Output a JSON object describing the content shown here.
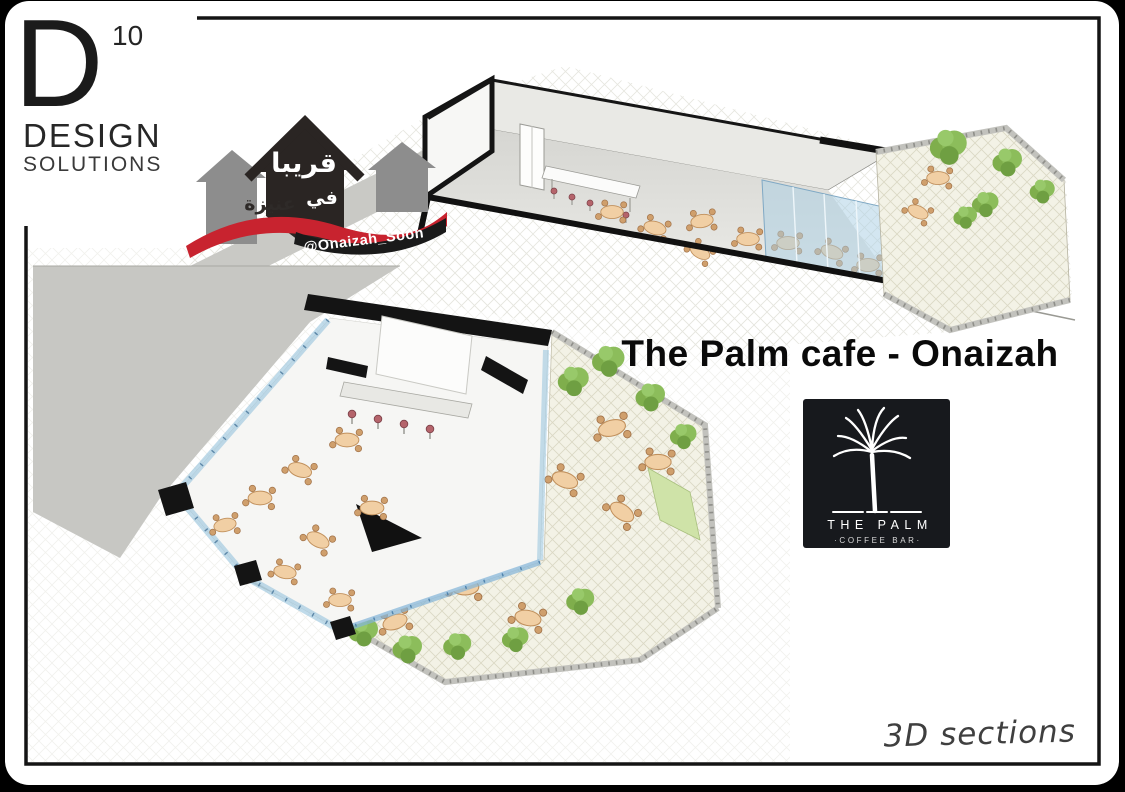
{
  "page": {
    "canvas_bg": "#000000",
    "card_bg": "#ffffff",
    "frame_color": "#141414"
  },
  "logo_d10": {
    "letter": "D",
    "superscript": "10",
    "line1": "DESIGN",
    "line2": "SOLUTIONS"
  },
  "logo_onaizah": {
    "arabic_top": "قريبا",
    "arabic_bottom_right": "في",
    "arabic_bottom_left": "عنيزة",
    "handle": "@Onaizah_Soon",
    "ribbon_color": "#c8232f",
    "house_color": "#2a2523",
    "side_house_color": "#8d8d8d"
  },
  "title": {
    "text": "The Palm cafe - Onaizah"
  },
  "logo_palm": {
    "name": "THE PALM",
    "tagline": "·COFFEE BAR·",
    "bg_color": "#17191d"
  },
  "caption": {
    "text": "3D sections"
  },
  "scene": {
    "top_view": "isometric-cutaway-section-cafe-interior-with-terrace",
    "bottom_view": "overhead-cutaway-section-cafe-with-outdoor-plaza",
    "glass_color": "#bcd8e8",
    "tree_color": "#86b551",
    "table_color": "#f1cfa4",
    "road_color": "#c9c9c5",
    "stool_color": "#b5646b",
    "terrace_color": "#f3f2e6"
  }
}
